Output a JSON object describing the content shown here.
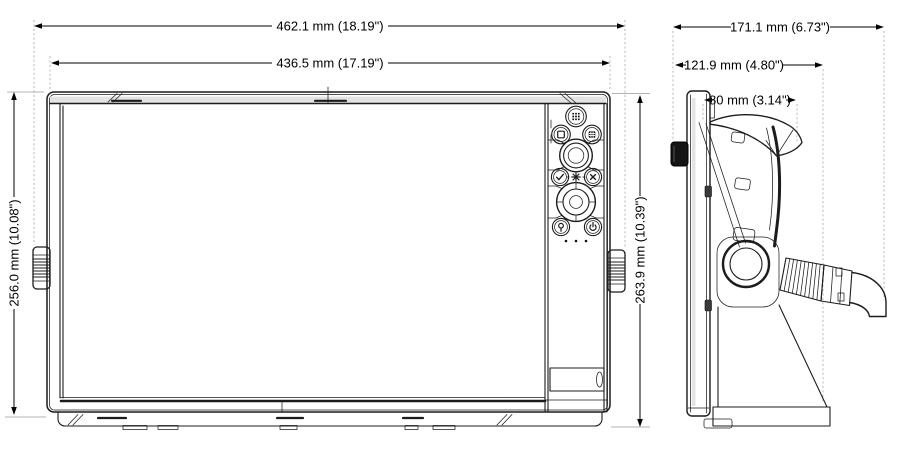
{
  "front_view": {
    "dims": {
      "overall_width": "462.1 mm (18.19\")",
      "screen_width": "436.5 mm (17.19\")",
      "left_height": "256.0 mm (10.08\")",
      "right_height": "263.9 mm (10.39\")"
    },
    "keypad": {
      "buttons": [
        {
          "name": "pages-button",
          "icon": "grid-dots"
        },
        {
          "name": "window-button",
          "icon": "square-outline"
        },
        {
          "name": "menu-button",
          "icon": "filled-grid"
        },
        {
          "name": "rotary-knob",
          "icon": "concentric-rings"
        },
        {
          "name": "accept-button",
          "icon": "checkmark"
        },
        {
          "name": "star-mark",
          "icon": "asterisk"
        },
        {
          "name": "exit-button",
          "icon": "cross"
        },
        {
          "name": "directional-pad",
          "icon": "ring-pad"
        },
        {
          "name": "waypoint-button",
          "icon": "map-pin"
        },
        {
          "name": "power-button",
          "icon": "power-symbol"
        }
      ]
    }
  },
  "side_view": {
    "dims": {
      "overall_depth": "171.1 mm (6.73\")",
      "bracket_depth": "121.9 mm (4.80\")",
      "mount_depth": "80 mm (3.14\")"
    }
  },
  "colors": {
    "line": "#1c1c1c",
    "dimension": "#000000",
    "extension": "#b3b3b3",
    "background": "#ffffff"
  }
}
